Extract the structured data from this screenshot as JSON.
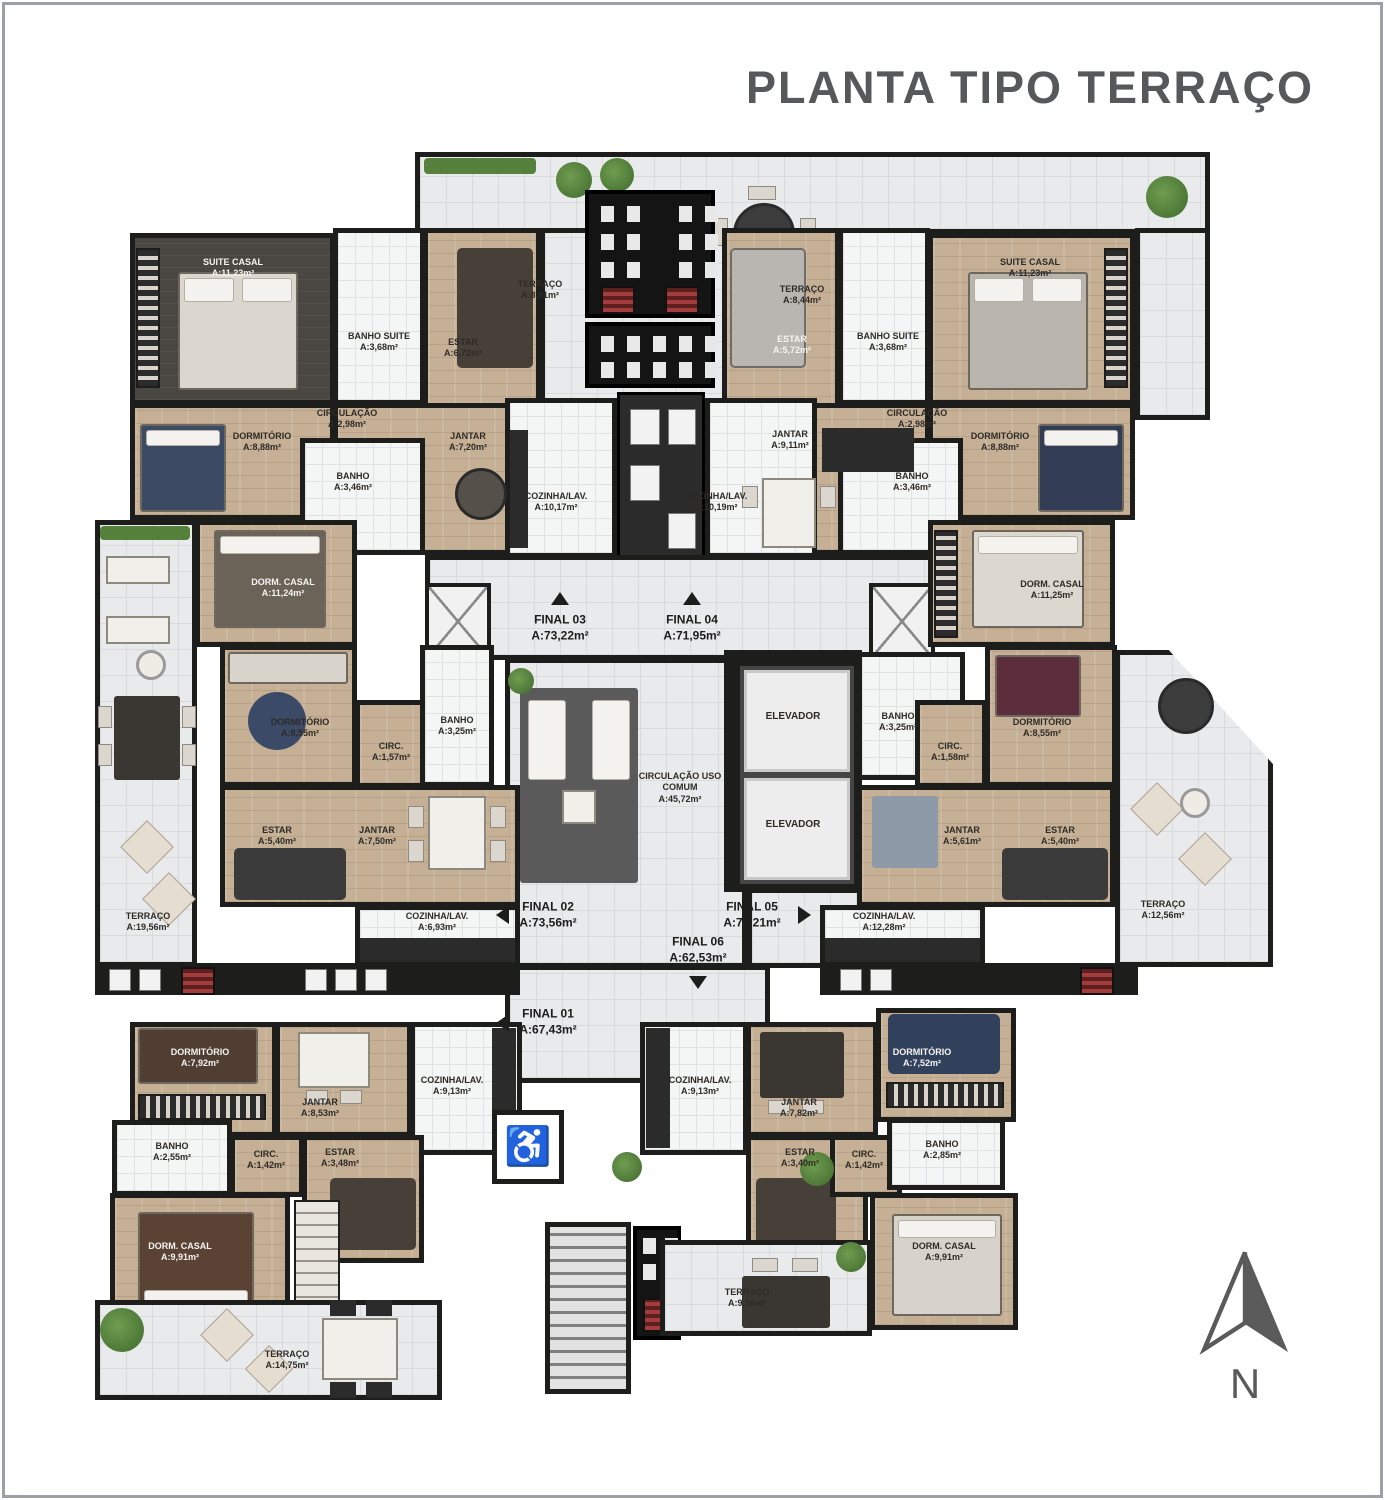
{
  "title": "PLANTA TIPO TERRAÇO",
  "compass": {
    "north_label": "N"
  },
  "common": {
    "circulacao_uso_comum": {
      "name": "CIRCULAÇÃO USO COMUM",
      "area": "A:45,72m²"
    },
    "elevador_1": "ELEVADOR",
    "elevador_2": "ELEVADOR"
  },
  "units": {
    "final_01": {
      "name": "FINAL 01",
      "area": "A:67,43m²"
    },
    "final_02": {
      "name": "FINAL 02",
      "area": "A:73,56m²"
    },
    "final_03": {
      "name": "FINAL 03",
      "area": "A:73,22m²"
    },
    "final_04": {
      "name": "FINAL 04",
      "area": "A:71,95m²"
    },
    "final_05": {
      "name": "FINAL 05",
      "area": "A:70,21m²"
    },
    "final_06": {
      "name": "FINAL 06",
      "area": "A:62,53m²"
    }
  },
  "apartments": {
    "final_03": {
      "suite_casal": {
        "name": "SUITE CASAL",
        "area": "A:11,23m²"
      },
      "banho_suite": {
        "name": "BANHO SUITE",
        "area": "A:3,68m²"
      },
      "estar": {
        "name": "ESTAR",
        "area": "A:6,72m²"
      },
      "circulacao": {
        "name": "CIRCULAÇÃO",
        "area": "A:2,98m²"
      },
      "dormitorio": {
        "name": "DORMITÓRIO",
        "area": "A:8,88m²"
      },
      "banho": {
        "name": "BANHO",
        "area": "A:3,46m²"
      },
      "jantar": {
        "name": "JANTAR",
        "area": "A:7,20m²"
      },
      "cozinha": {
        "name": "COZINHA/LAV.",
        "area": "A:10,17m²"
      },
      "terraco": {
        "name": "TERRAÇO",
        "area": "A:8,91m²"
      }
    },
    "final_04": {
      "suite_casal": {
        "name": "SUITE CASAL",
        "area": "A:11,23m²"
      },
      "banho_suite": {
        "name": "BANHO SUITE",
        "area": "A:3,68m²"
      },
      "estar": {
        "name": "ESTAR",
        "area": "A:5,72m²"
      },
      "circulacao": {
        "name": "CIRCULAÇÃO",
        "area": "A:2,98m²"
      },
      "dormitorio": {
        "name": "DORMITÓRIO",
        "area": "A:8,88m²"
      },
      "banho": {
        "name": "BANHO",
        "area": "A:3,46m²"
      },
      "jantar": {
        "name": "JANTAR",
        "area": "A:9,11m²"
      },
      "cozinha": {
        "name": "COZINHA/LAV.",
        "area": "A:10,19m²"
      },
      "terraco": {
        "name": "TERRAÇO",
        "area": "A:8,44m²"
      }
    },
    "final_02": {
      "dorm_casal": {
        "name": "DORM. CASAL",
        "area": "A:11,24m²"
      },
      "dormitorio": {
        "name": "DORMITÓRIO",
        "area": "A:8,55m²"
      },
      "circ": {
        "name": "CIRC.",
        "area": "A:1,57m²"
      },
      "banho": {
        "name": "BANHO",
        "area": "A:3,25m²"
      },
      "estar": {
        "name": "ESTAR",
        "area": "A:5,40m²"
      },
      "jantar": {
        "name": "JANTAR",
        "area": "A:7,50m²"
      },
      "cozinha": {
        "name": "COZINHA/LAV.",
        "area": "A:6,93m²"
      },
      "terraco": {
        "name": "TERRAÇO",
        "area": "A:19,56m²"
      }
    },
    "final_05": {
      "dorm_casal": {
        "name": "DORM. CASAL",
        "area": "A:11,25m²"
      },
      "dormitorio": {
        "name": "DORMITÓRIO",
        "area": "A:8,55m²"
      },
      "circ": {
        "name": "CIRC.",
        "area": "A:1,58m²"
      },
      "banho": {
        "name": "BANHO",
        "area": "A:3,25m²"
      },
      "estar": {
        "name": "ESTAR",
        "area": "A:5,40m²"
      },
      "jantar": {
        "name": "JANTAR",
        "area": "A:5,61m²"
      },
      "cozinha": {
        "name": "COZINHA/LAV.",
        "area": "A:12,28m²"
      },
      "terraco": {
        "name": "TERRAÇO",
        "area": "A:12,56m²"
      }
    },
    "final_01": {
      "dormitorio": {
        "name": "DORMITÓRIO",
        "area": "A:7,92m²"
      },
      "jantar": {
        "name": "JANTAR",
        "area": "A:8,53m²"
      },
      "banho": {
        "name": "BANHO",
        "area": "A:2,55m²"
      },
      "circ": {
        "name": "CIRC.",
        "area": "A:1,42m²"
      },
      "estar": {
        "name": "ESTAR",
        "area": "A:3,48m²"
      },
      "dorm_casal": {
        "name": "DORM. CASAL",
        "area": "A:9,91m²"
      },
      "cozinha": {
        "name": "COZINHA/LAV.",
        "area": "A:9,13m²"
      },
      "terraco": {
        "name": "TERRAÇO",
        "area": "A:14,75m²"
      }
    },
    "final_06": {
      "dormitorio": {
        "name": "DORMITÓRIO",
        "area": "A:7,52m²"
      },
      "jantar": {
        "name": "JANTAR",
        "area": "A:7,82m²"
      },
      "banho": {
        "name": "BANHO",
        "area": "A:2,85m²"
      },
      "circ": {
        "name": "CIRC.",
        "area": "A:1,42m²"
      },
      "estar": {
        "name": "ESTAR",
        "area": "A:3,40m²"
      },
      "dorm_casal": {
        "name": "DORM. CASAL",
        "area": "A:9,91m²"
      },
      "cozinha": {
        "name": "COZINHA/LAV.",
        "area": "A:9,13m²"
      },
      "terraco": {
        "name": "TERRAÇO",
        "area": "A:9,56m²"
      }
    }
  },
  "colors": {
    "wall": "#1d1d1b",
    "wood_floor": "#c5b096",
    "tile_floor": "#e9eaeb",
    "dark_floor": "#4a4742",
    "title_text": "#57585a",
    "plant_green": "#55813c"
  }
}
